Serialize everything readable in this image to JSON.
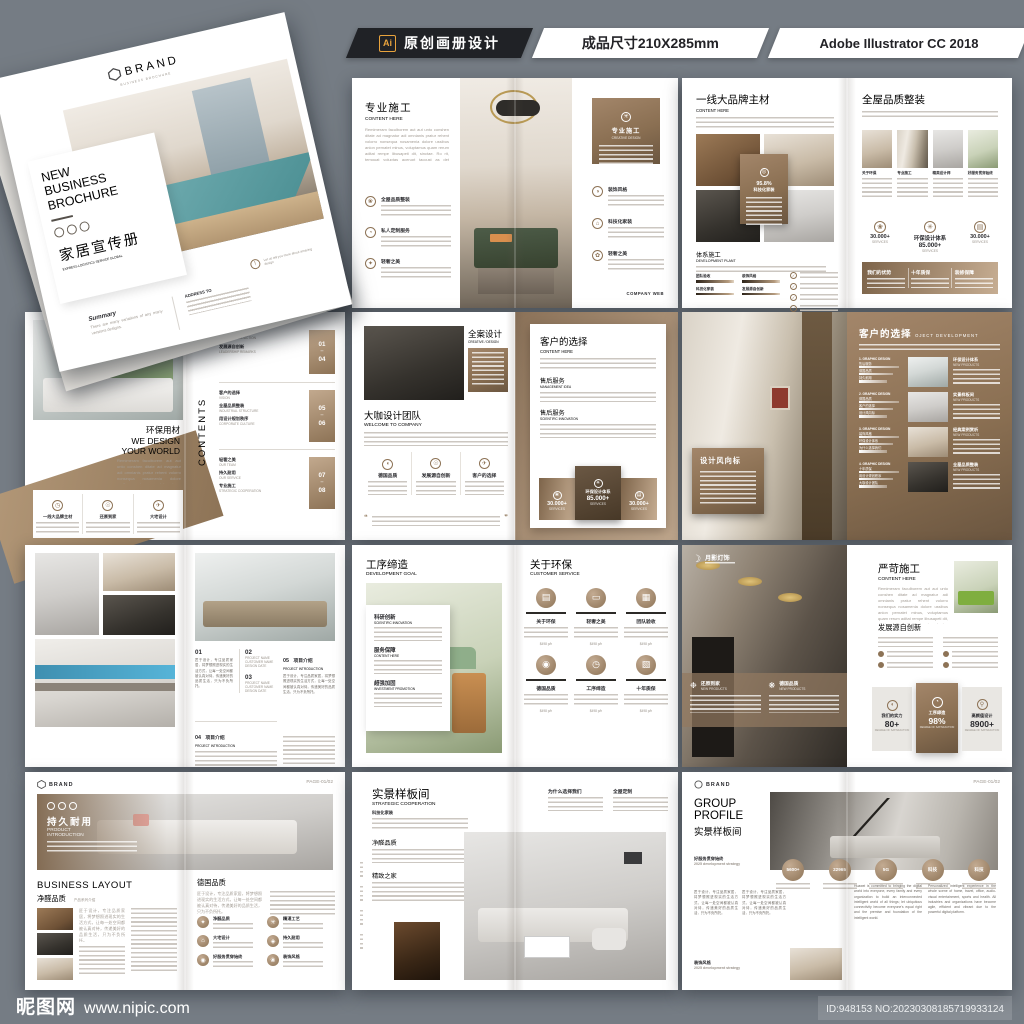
{
  "topbar": {
    "ai_badge": "Ai",
    "title": "原创画册设计",
    "size": "成品尺寸210X285mm",
    "software": "Adobe Illustrator CC 2018"
  },
  "footer": {
    "site": "昵图网",
    "url": "www.nipic.com",
    "id_text": "ID:948153 NO:20230308185719933124"
  },
  "colors": {
    "background": "#757c84",
    "accent_brown": "#8d7356",
    "brown_light": "#c7ae93",
    "topbar_black": "#202226",
    "ai_orange": "#e8a33d"
  },
  "common": {
    "lorem": "Remimeram faculborem aut aut unto conshen ditate ad magnatur adi omnianis pratur rehent volorro nonsequa nosamenia dolore ussibus anion pernatet minus, voluptamus quam rerum aditat rempe libusapeti dit, sinctae. Ro rit, temquat voluptas acerupt taccust as det matupitas debit modis.",
    "lorem_cn": "匠于设计，专注品质家居，将梦想照进现实的生活方式，让每一处空间都被认真对待，传递美好的品质生活，只为不负所托。",
    "huawei_1": "Huawei is committed to bringing the digital world into everyone, every family and every organization to build an interconnected intelligent world of all things; let ubiquitous connectivity become everyone's equal right and the premise and foundation of the intelligent world.",
    "huawei_2": "Personalized intelligent experience in the whole scene of home, travel, office, audio-visual entertainment, sports and health. All industries and organizations have become agile, efficient and vibrant due to the powerful digital platform."
  },
  "cover": {
    "brand": "BRAND",
    "brand_sub": "BUSINESS BROCHURE",
    "title1": "NEW",
    "title2": "BUSINESS",
    "title3": "BROCHURE",
    "cn_title": "家居宣传册",
    "tagline": "EXPRESS LOGISTICS SERVICE GLOBAL",
    "summary_label": "Summary",
    "summary_text": "There are many variations of any many versions designs.",
    "address_label": "ADDRESS TO",
    "note": "Let us tell you more about amazing design"
  },
  "s_pro": {
    "left": {
      "title": "专业施工",
      "sub": "CONTENT HERE",
      "items": [
        "全屋品质整装",
        "私人定制服务",
        "轻奢之美"
      ]
    },
    "right": {
      "box_title": "专业施工",
      "box_sub": "CREATIVE DESIGN",
      "items": [
        "装饰风格",
        "科技化家装",
        "轻奢之美"
      ],
      "web": "COMPANY WEB"
    }
  },
  "s_brand": {
    "left": {
      "title": "一线大品牌主材",
      "sub": "CONTENT HERE",
      "card_value": "95.8%",
      "card_label": "科技化家装",
      "sec": "体系施工",
      "sec_sub": "DEVELOPMENT PLANT",
      "bars": [
        "团队验收",
        "装饰风格",
        "科技化家装",
        "发展源自创新"
      ]
    },
    "right": {
      "title": "全屋品质整装",
      "cols": [
        "关于环保",
        "专业施工",
        "精英设计师",
        "好服务贯穿始终"
      ],
      "stat_left": "30.000+",
      "stat_left_sub": "SERVICES",
      "stat_center_title": "环保设计体系",
      "stat_center_value": "85.000+",
      "stat_center_sub": "SERVICES",
      "stat_right": "30.000+",
      "stat_right_sub": "SERVICES",
      "bottom": [
        "我们的优势",
        "十年质保",
        "装修保障"
      ]
    }
  },
  "s_eco": {
    "left": {
      "title_cn": "环保用材",
      "title_en1": "WE DESIGN",
      "title_en2": "YOUR WORLD",
      "features": [
        "一线大品牌主材",
        "还原到家",
        "大宅设计"
      ]
    },
    "right": {
      "vertical": "CONTENTS",
      "groups": [
        {
          "n1": "01",
          "n2": "04",
          "items": [
            {
              "cn": "集团简介",
              "en": "GROUP INTRODUCTION"
            },
            {
              "cn": "发展源自创新",
              "en": "LEADERSHIP REMARKS"
            }
          ]
        },
        {
          "n1": "05",
          "n2": "06",
          "items": [
            {
              "cn": "客户的选择",
              "en": "VISION"
            },
            {
              "cn": "全屋品质整装",
              "en": "INDUSTRIAL STRUCTURE"
            },
            {
              "cn": "用设计规划秩序",
              "en": "CORPORATE CULTURE"
            }
          ]
        },
        {
          "n1": "07",
          "n2": "08",
          "items": [
            {
              "cn": "轻奢之美",
              "en": "OUR TEAM"
            },
            {
              "cn": "持久耐用",
              "en": "OUR SERVICE"
            },
            {
              "cn": "专业施工",
              "en": "STRATEGIC COOPERATION"
            }
          ]
        }
      ]
    }
  },
  "s_design": {
    "left": {
      "photo_title": "全案设计",
      "photo_sub": "CREATIVE / DESIGN",
      "title": "大咖设计团队",
      "sub": "WELCOME TO COMPANY",
      "features": [
        "德国品质",
        "发展源自创新",
        "客户的选择"
      ]
    },
    "right": {
      "card_title": "客户的选择",
      "card_sub": "CONTENT HERE",
      "sec1": "售后服务",
      "sec1_sub": "MANAGEMENT IDEA",
      "sec2": "售后服务",
      "sec2_sub": "SCIENTIFIC INNOVATION",
      "stat_left": "30.000+",
      "stat_left_sub": "SERVICES",
      "stat_center_title": "环保设计体系",
      "stat_center_value": "85.000+",
      "stat_center_sub": "SERVICES",
      "stat_right": "30.000+",
      "stat_right_sub": "SERVICES"
    }
  },
  "s_style": {
    "left": {
      "card_title": "设计风向标"
    },
    "right": {
      "title": "客户的选择",
      "sub": "OJECT DEVELOPMENT",
      "rows": [
        {
          "label": "1. GRAPHIC DESIGN",
          "bars": [
            "售后服务",
            "德国品质",
            "持久耐用"
          ],
          "cap": "环保设计体系",
          "cap_sub": "NEW PRODUCTS"
        },
        {
          "label": "2. GRAPHIC DESIGN",
          "bars": [
            "德国品质",
            "客户的选择",
            "设计风向标"
          ],
          "cap": "实景样板间",
          "cap_sub": "NEW PRODUCTS"
        },
        {
          "label": "3. GRAPHIC DESIGN",
          "bars": [
            "装饰风格",
            "环保设计体系",
            "为什么选择我们"
          ],
          "cap": "经典案例赏析",
          "cap_sub": "NEW PRODUCTS"
        },
        {
          "label": "4. GRAPHIC DESIGN",
          "bars": [
            "十年质保",
            "用设计规划秩序",
            "大咖设计团队"
          ],
          "cap": "全屋品质整装",
          "cap_sub": "NEW PRODUCTS"
        }
      ]
    }
  },
  "s_projects": {
    "right": {
      "n1": "01",
      "n2": "02",
      "n2_lines": [
        "PROJECT NAME",
        "CUSTOMER NAME",
        "DESIGN DATE"
      ],
      "n3": "03",
      "n3_lines": [
        "PROJECT NAME",
        "CUSTOMER NAME",
        "DESIGN DATE"
      ],
      "n4": "04",
      "n4_title": "项目介绍",
      "n4_sub": "PROJECT INTRODUCTION",
      "n5": "05",
      "n5_title": "项目介绍",
      "n5_sub": "PROJECT INTRODUCTION"
    }
  },
  "s_process": {
    "left": {
      "title": "工序缔造",
      "sub": "DEVELOPMENT GOAL",
      "items": [
        {
          "t": "科研创新",
          "s": "SCIENTIFIC INNOVATION"
        },
        {
          "t": "服务保障",
          "s": "CONTENT HERE"
        },
        {
          "t": "超强加固",
          "s": "INVESTMENT PROMOTION"
        }
      ]
    },
    "right": {
      "title": "关于环保",
      "sub": "CUSTOMER SERVICE",
      "cells": [
        "关于环保",
        "轻奢之美",
        "团队验收",
        "德国品质",
        "工序缔造",
        "十年质保"
      ],
      "price": "$498 p/h"
    }
  },
  "s_strict": {
    "left": {
      "logo": "月影灯饰",
      "band": [
        {
          "t": "还原到家",
          "s": "NEW PRODUCTS"
        },
        {
          "t": "德国品质",
          "s": "NEW PRODUCTS"
        }
      ]
    },
    "right": {
      "title": "严苛施工",
      "sub": "CONTENT HERE",
      "sec": "发展源自创新",
      "stats": [
        {
          "label": "我们的实力",
          "value": "80+",
          "sub": "DEGREE OF SATISFACTION"
        },
        {
          "label": "工序缔造",
          "value": "98%",
          "sub": "DEGREE OF SATISFACTION"
        },
        {
          "label": "高颜值设计",
          "value": "8900+",
          "sub": "DEGREE OF SATISFACTION"
        }
      ]
    }
  },
  "s_durable": {
    "brand": "BRAND",
    "page": "PAGE-01/02",
    "banner_title": "持久耐用",
    "banner_sub1": "PRODUCT",
    "banner_sub2": "INTRODUCTION",
    "sec_en": "BUSINESS LAYOUT",
    "sec_cn": "净醛品质",
    "sec_note": "产品系列介绍",
    "right_title": "德国品质",
    "grid": [
      "净醛品质",
      "精湛工艺",
      "大宅设计",
      "持久耐用",
      "好服务贯穿始终",
      "装饰风格"
    ]
  },
  "s_showroom": {
    "title": "实景样板间",
    "sub": "STRATEGIC COOPERATION",
    "sub2": "科技化家装",
    "sec1": "净醛品质",
    "sec2": "精致之家",
    "right_h1": "为什么选择我们",
    "right_h2": "全屋定制"
  },
  "s_group": {
    "brand": "BRAND",
    "page": "PAGE-01/02",
    "title1": "GROUP",
    "title2": "PROFILE",
    "title3": "实景样板间",
    "left_label": "好服务贯穿始终",
    "left_sub": "2025 development strategy",
    "badges": [
      "5600+",
      "22965",
      "5G",
      "科技",
      "科技"
    ],
    "bottom_label": "装饰风格",
    "bottom_sub": "2025 development strategy"
  }
}
